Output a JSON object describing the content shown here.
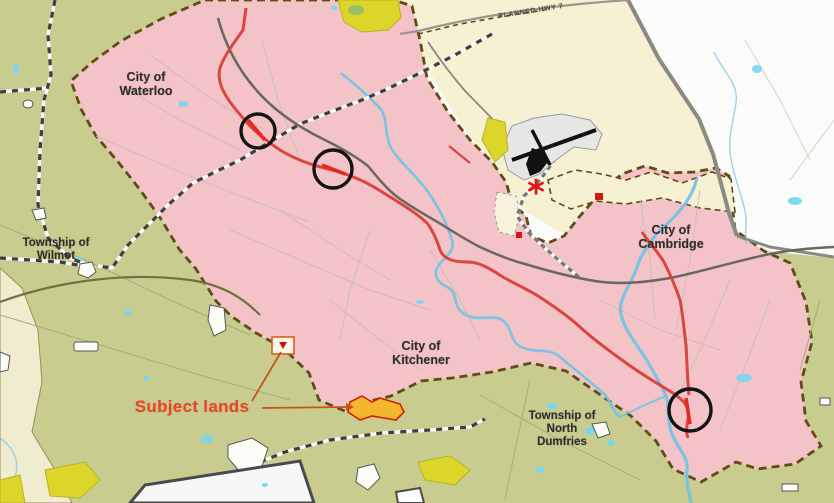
{
  "map": {
    "region_labels": {
      "city_waterloo": {
        "line1": "City of",
        "line2": "Waterloo"
      },
      "township_wilmot": {
        "line1": "Township of",
        "line2": "Wilmot"
      },
      "city_kitchener": {
        "line1": "City of",
        "line2": "Kitchener"
      },
      "city_cambridge": {
        "line1": "City of",
        "line2": "Cambridge"
      },
      "township_north_dumfries": {
        "line1": "Township of",
        "line2": "North",
        "line3": "Dumfries"
      }
    },
    "annotations": {
      "planned_hwy_label": "PLANNED HWY 7",
      "subject_lands_label": "Subject lands",
      "highlight_circles": [
        {
          "x": 258,
          "y": 131,
          "r": 17
        },
        {
          "x": 333,
          "y": 169,
          "r": 19
        },
        {
          "x": 690,
          "y": 410,
          "r": 21
        }
      ],
      "star": {
        "x": 536,
        "y": 204,
        "glyph": "*"
      }
    },
    "colors": {
      "urban_pink": "#f3c3c8",
      "township_olive": "#c9cc8f",
      "rural_cream": "#f6f1d3",
      "west_cream": "#f0ecd0",
      "outside_white": "#fbfbf9",
      "settlement_yellow": "#ddd62a",
      "water_blue": "#74c3e4",
      "lake_cyan": "#7bd6f0",
      "boundary_brown": "#5f4c16",
      "region_grey": "#8a8a84",
      "highway_red": "#d84038",
      "road_dark": "#6b6660",
      "road_light": "#c4beb6",
      "circle_black": "#141414",
      "subject_red": "#e5472b",
      "marker_red": "#d41818"
    }
  }
}
